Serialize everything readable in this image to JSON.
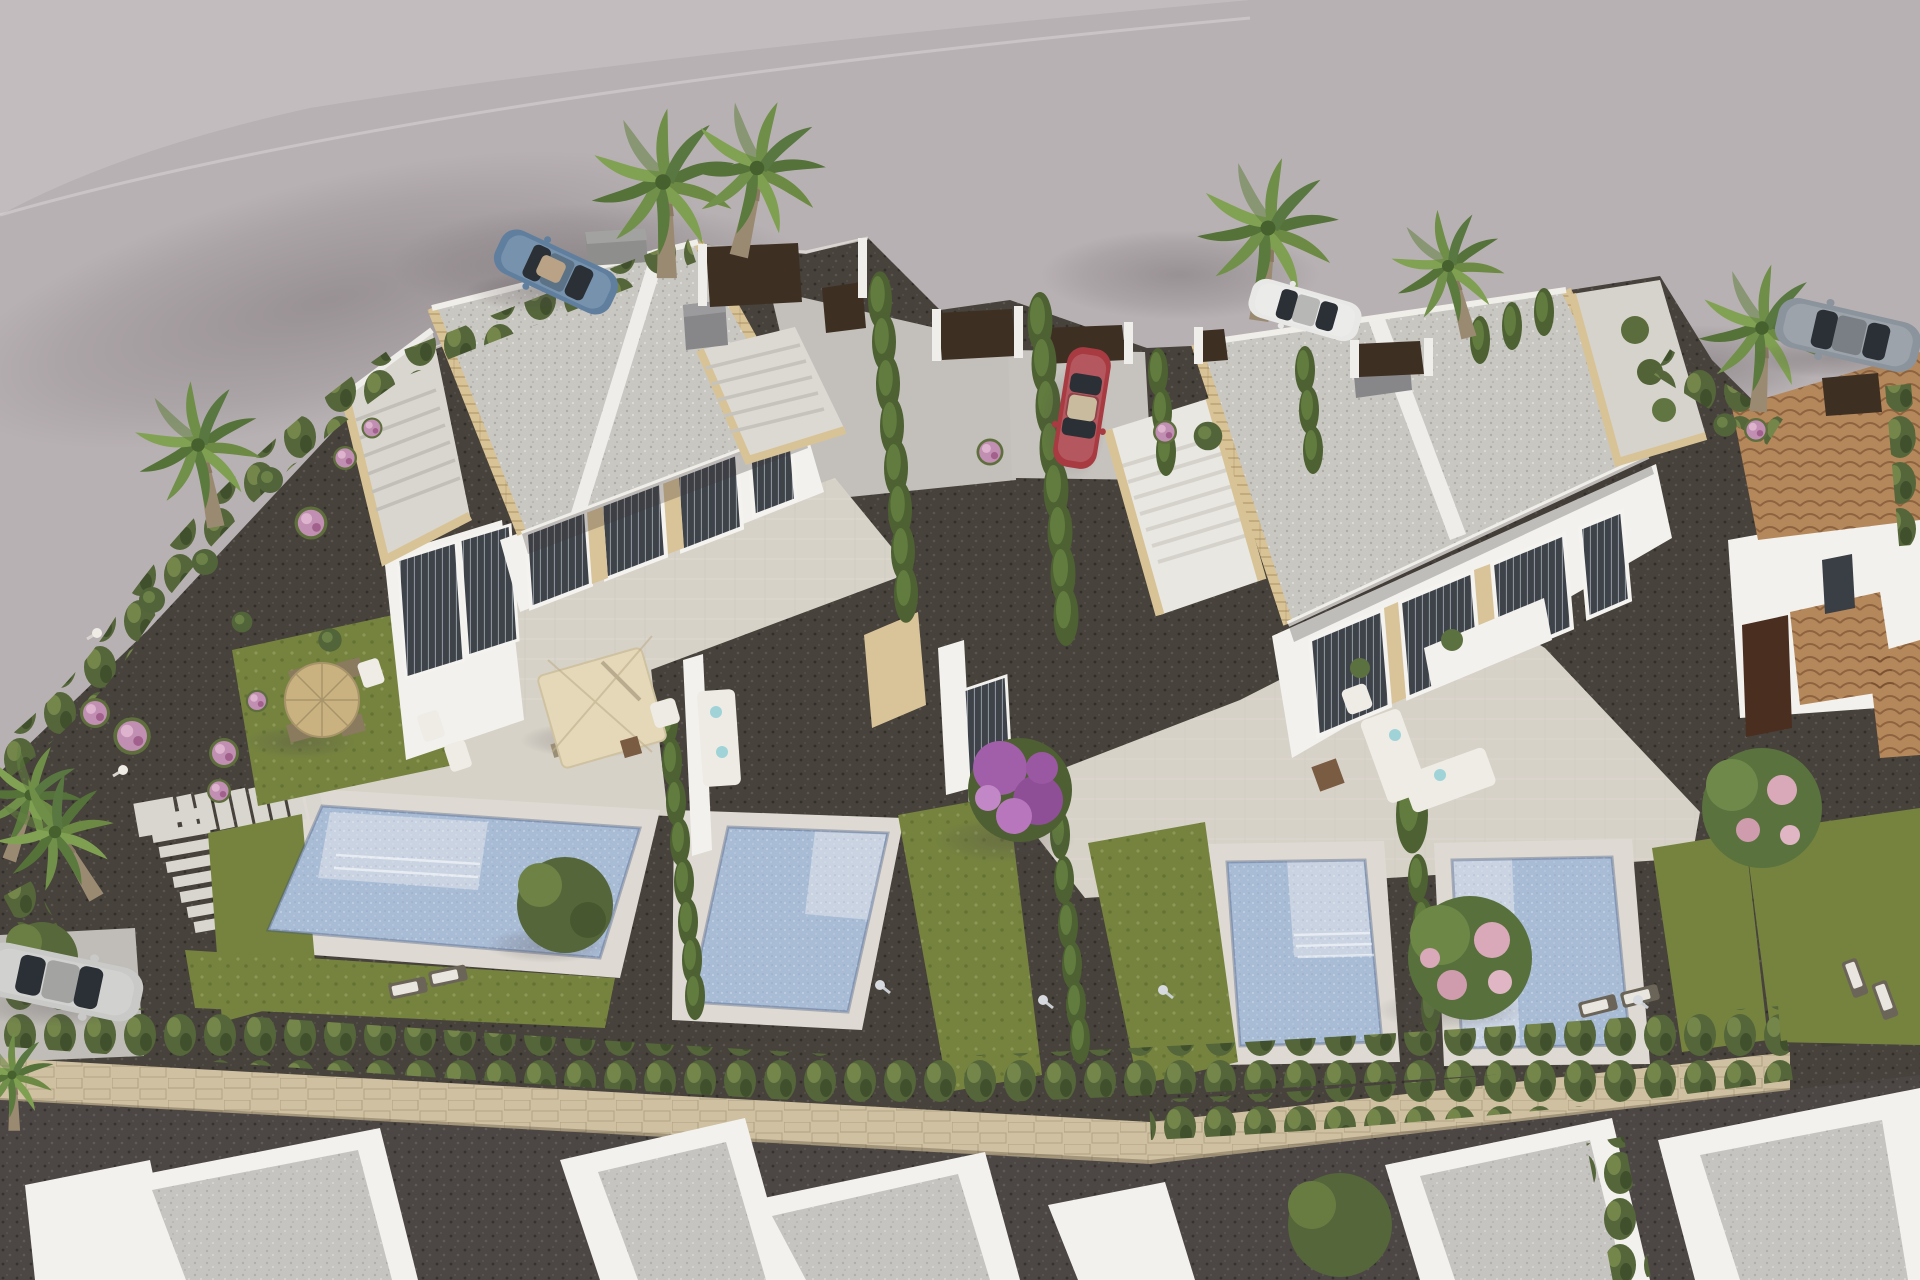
{
  "scene": {
    "type": "3D architectural aerial rendering",
    "setting": "modern Mediterranean residential villa development",
    "view": "bird's-eye oblique aerial",
    "lighting": "warm late-afternoon sun from upper right"
  },
  "buildings": {
    "villa_left": {
      "name": "semi-detached white villa block 1",
      "roof": "flat gravel roof with solarium terraces and stairs",
      "features": [
        "sandstone trim walls",
        "floor-to-ceiling windows with grey blinds",
        "roof access stairs",
        "travertine terrace",
        "cream cantilever parasol with dining set",
        "thatched garden umbrella with chairs"
      ]
    },
    "villa_right": {
      "name": "semi-detached white villa block 2",
      "roof": "flat gravel roof with solarium terraces and stairs",
      "features": [
        "sandstone trim walls",
        "large glazed facade",
        "white outdoor lounge sofas",
        "roof access stairs"
      ]
    },
    "neighbor_right": {
      "name": "existing house with terracotta tiled roof and dark timber door"
    },
    "bottom_row": {
      "name": "row of white flat-roof houses along lower street",
      "count": 6
    }
  },
  "pools": [
    {
      "name": "villa 1 main swimming pool with tanning ledge"
    },
    {
      "name": "villa 1 second plunge pool"
    },
    {
      "name": "villa 2 swimming pool with steps and tanning ledge"
    },
    {
      "name": "villa 2 second swimming pool with side ledge"
    }
  ],
  "vehicles": [
    {
      "name": "blue convertible sports car",
      "location": "upper road"
    },
    {
      "name": "red sedan",
      "location": "central gravel driveway"
    },
    {
      "name": "white sedan",
      "location": "right driveway entrance under palms"
    },
    {
      "name": "grey SUV",
      "location": "far right road edge"
    },
    {
      "name": "silver hatchback",
      "location": "lower left driveway"
    }
  ],
  "vegetation": {
    "palm_trees": 8,
    "cypress_hedge_rows": "property boundaries and pool dividers",
    "bougainvillea_tree": "purple, central garden",
    "flowering_trees": "pink blossom trees in right gardens",
    "shrubs": "pink and lilac flowering balls in left rock garden",
    "lawns": 7
  },
  "hardscape": [
    "curved light asphalt road",
    "dark gravel garden paths",
    "stepping stone path",
    "natural stone boundary wall with hedge",
    "travertine pool decks and terraces",
    "dark brown entrance gates",
    "outdoor showers and bollard lights"
  ],
  "colors": {
    "road": "#b8b1b3",
    "road_light": "#c7c0c2",
    "gravel_dark": "#47423b",
    "hedge": "#5c6e3c",
    "lawn": "#75833f",
    "pool_water": "#a9bcd6",
    "pool_shelf": "#c9d3e2",
    "villa_white": "#f2f1ed",
    "roof_gravel": "#c9c7c2",
    "sandstone": "#d9c398",
    "travertine": "#d7d2c8",
    "deck": "#dedad3",
    "stone_wall": "#cec0a1",
    "terracotta": "#b5885c",
    "gate_brown": "#3e2f23",
    "car_blue": "#607f9f",
    "car_red": "#a83a42",
    "car_white": "#e8e8e6",
    "car_gray": "#8b939c",
    "car_silver": "#c9cac8"
  }
}
